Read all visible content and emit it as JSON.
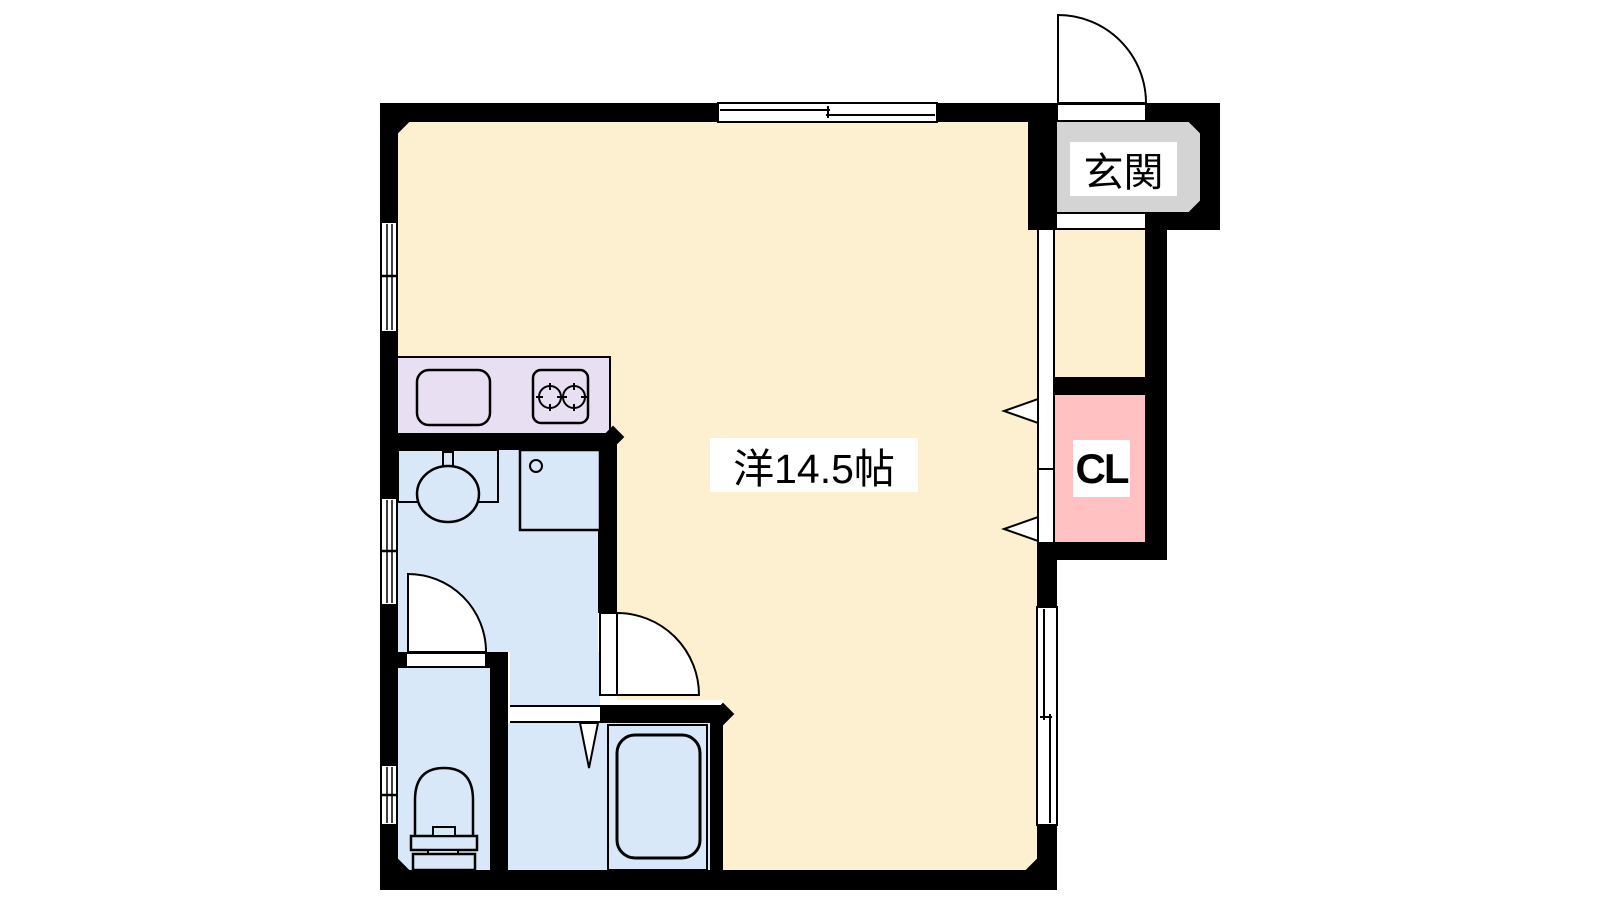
{
  "plan": {
    "type": "apartment-floor-plan",
    "labels": {
      "main_room": "洋14.5帖",
      "entrance": "玄関",
      "closet": "CL"
    },
    "colors": {
      "wall": "#000000",
      "main_room_floor": "#fcf0d1",
      "kitchen_counter": "#e8e0f2",
      "wet_area_floor": "#d9e8f8",
      "closet": "#ffc1c1",
      "entrance_floor": "#d4d4d4",
      "background": "#ffffff"
    },
    "fixtures": [
      "kitchen-sink",
      "gas-stove-two-burners",
      "washbasin",
      "washing-machine-pan",
      "toilet",
      "bathtub"
    ],
    "openings": [
      "entrance-swing-door",
      "sliding-window-top",
      "sliding-window-right",
      "casement-window-left-upper",
      "casement-window-left-middle",
      "casement-window-left-lower",
      "washroom-swing-door",
      "toilet-swing-door",
      "bath-folding-door",
      "closet-bifold-doors",
      "genkan-opening"
    ]
  }
}
